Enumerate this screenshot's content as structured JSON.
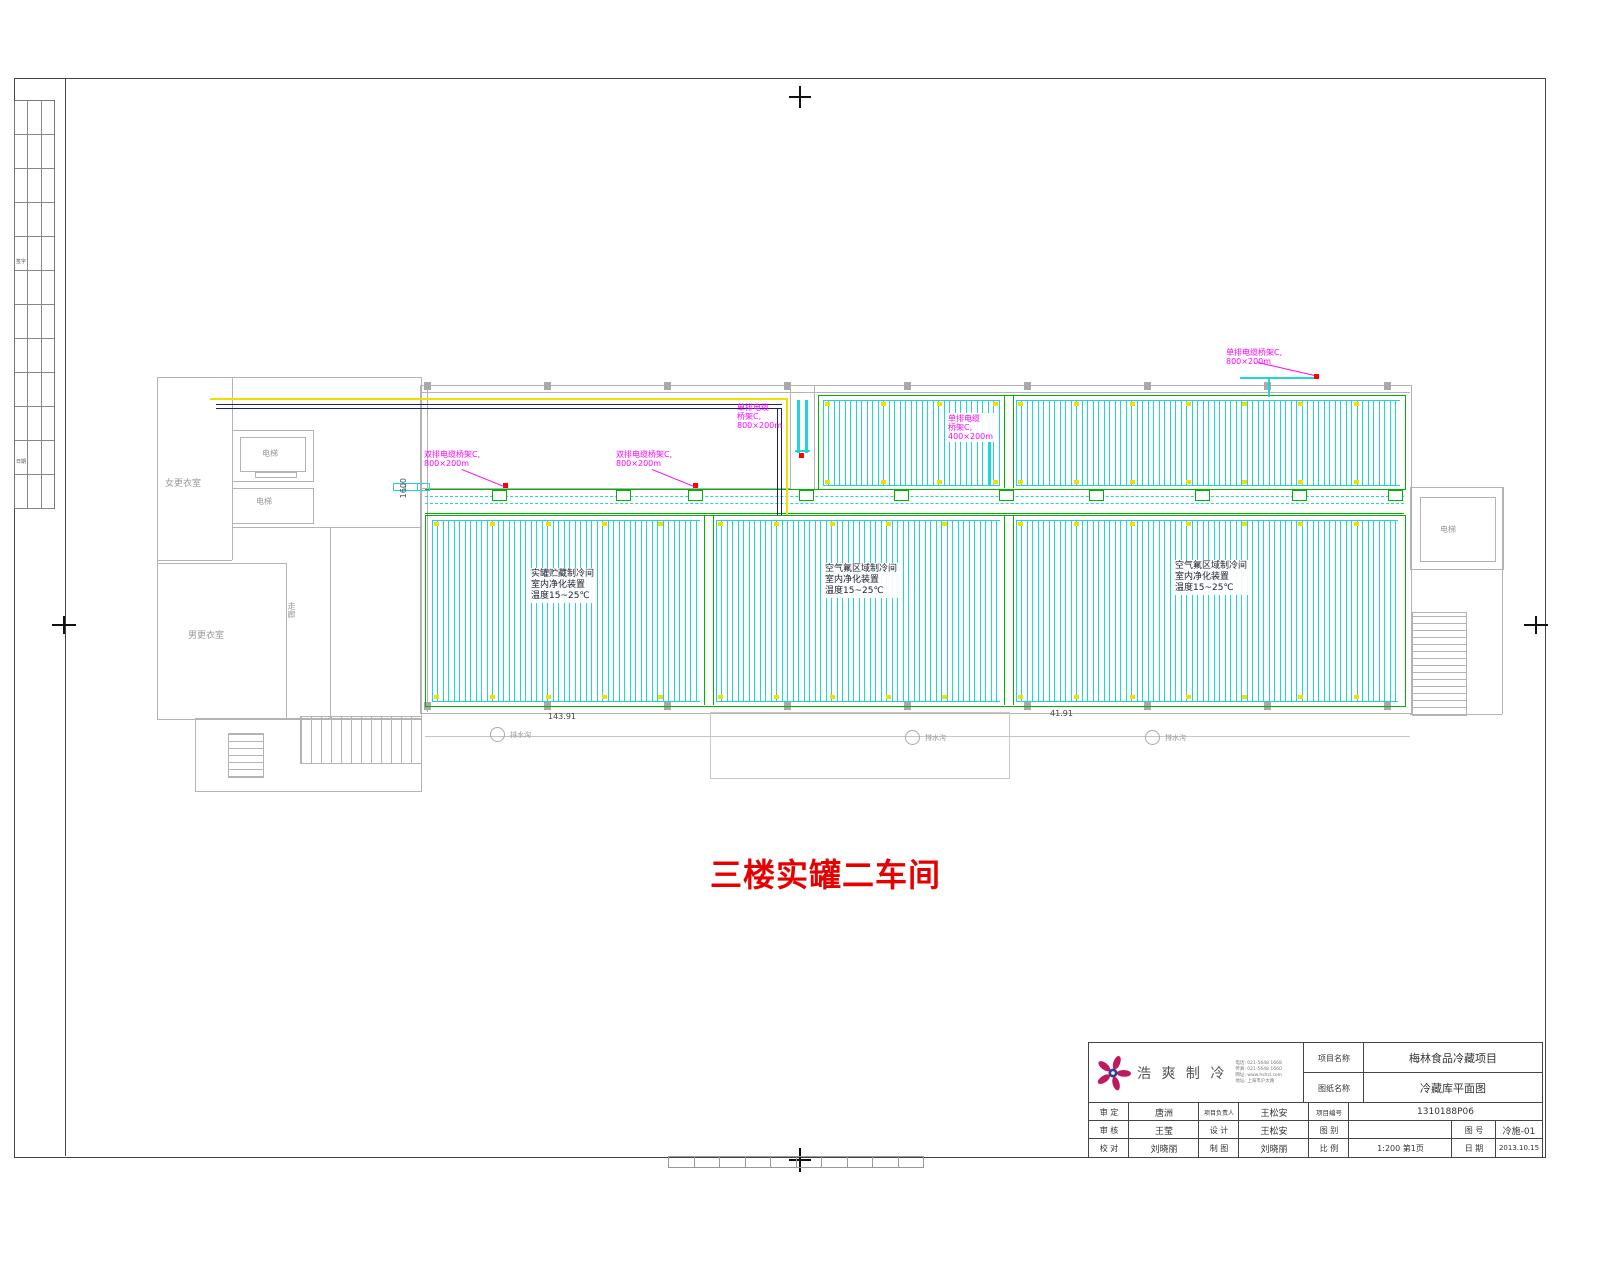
{
  "strip": {
    "label1": "签字",
    "label2": "日期"
  },
  "plan": {
    "title": "三楼实罐二车间",
    "rooms": {
      "womens": "女更衣室",
      "mens": "男更衣室",
      "elev_a": "电梯",
      "elev_b": "电梯",
      "corridor": "走廊",
      "elev_right": "电梯"
    },
    "bays": {
      "bay1": [
        "实罐贮藏制冷间",
        "室内净化装置",
        "温度15~25℃"
      ],
      "bay2": [
        "空气氟区域制冷间",
        "室内净化装置",
        "温度15~25℃"
      ],
      "bay3": [
        "空气氟区域制冷间",
        "室内净化装置",
        "温度15~25℃"
      ]
    },
    "trays": {
      "t1": [
        "双排电缆桥架C,",
        "800×200m"
      ],
      "t2": [
        "双排电缆桥架C,",
        "800×200m"
      ],
      "t3": [
        "单排电缆",
        "桥架C,",
        "800×200m"
      ],
      "t4": [
        "单排电缆",
        "桥架C,",
        "400×200m"
      ],
      "t5": [
        "单排电缆桥架C,",
        "800×200m"
      ]
    },
    "dims": {
      "v1600": "1600",
      "d1": "143.91",
      "d2": "41.91"
    },
    "drains": [
      "排水沟",
      "排水沟",
      "排水沟"
    ]
  },
  "tb": {
    "company": "浩 爽 制 冷",
    "contacts": [
      "电话: 021-5648 1668",
      "传真: 021-5648 1660",
      "网址: www.hshzl.com",
      "地址: 上海市沪太路"
    ],
    "project_label": "项目名称",
    "project_value": "梅林食品冷藏项目",
    "drawing_label": "图纸名称",
    "drawing_value": "冷藏库平面图",
    "rows": [
      {
        "c1": "审 定",
        "c2": "唐洲",
        "c3": "项目负责人",
        "c4": "王松安",
        "c5": "项目编号",
        "c6": "1310188P06",
        "c7": "",
        "c8": ""
      },
      {
        "c1": "审 核",
        "c2": "王莹",
        "c3": "设 计",
        "c4": "王松安",
        "c5": "图 别",
        "c6": "",
        "c7": "图 号",
        "c8": "冷施-01"
      },
      {
        "c1": "校 对",
        "c2": "刘晓丽",
        "c3": "制 图",
        "c4": "刘晓丽",
        "c5": "比 例",
        "c6": "1:200 第1页",
        "c7": "日 期",
        "c8": "2013.10.15"
      }
    ]
  },
  "colors": {
    "coil_cyan": "#1fd6d6",
    "pipe_green": "#00b400",
    "tray_magenta_label": "#ff00ff",
    "tray_yellow": "#f0e000",
    "tray_navy": "#1b1b8a",
    "title_red": "#e60000",
    "marker_red": "#ff0000"
  }
}
